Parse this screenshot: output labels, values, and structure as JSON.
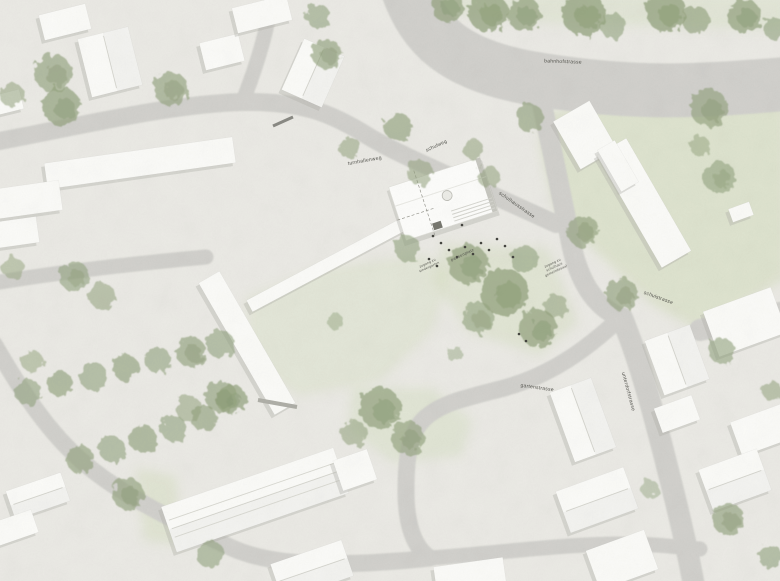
{
  "labels": {
    "streets": {
      "bahnhofstrasse": "bahnhofstrasse",
      "turnhallenweg": "turnhallenweg",
      "schulweg": "schulweg",
      "schulhausstrasse": "schulhausstrasse",
      "schulstrasse": "schulstrasse",
      "gartenstrasse": "gartenstrasse",
      "unterdorfstrasse": "unterdorfstrasse"
    },
    "areas": {
      "pausenplatz": "pausenplatz"
    },
    "annotations": {
      "zugang_kindergarten": {
        "line1": "zugang zu",
        "line2": "kindergarten"
      },
      "zugang_gemeinde": {
        "line1": "zugang zu",
        "line2": "schulhaus",
        "line3": "gemeindesaal"
      }
    }
  },
  "colors": {
    "paper": "#ebeae5",
    "road": "#d2d1cd",
    "building": "#fbfbf8",
    "building_shadow": "#b2b2aa",
    "lawn": "#d8e0c6",
    "tree": "#93a37e",
    "label_text": "#54544e"
  }
}
